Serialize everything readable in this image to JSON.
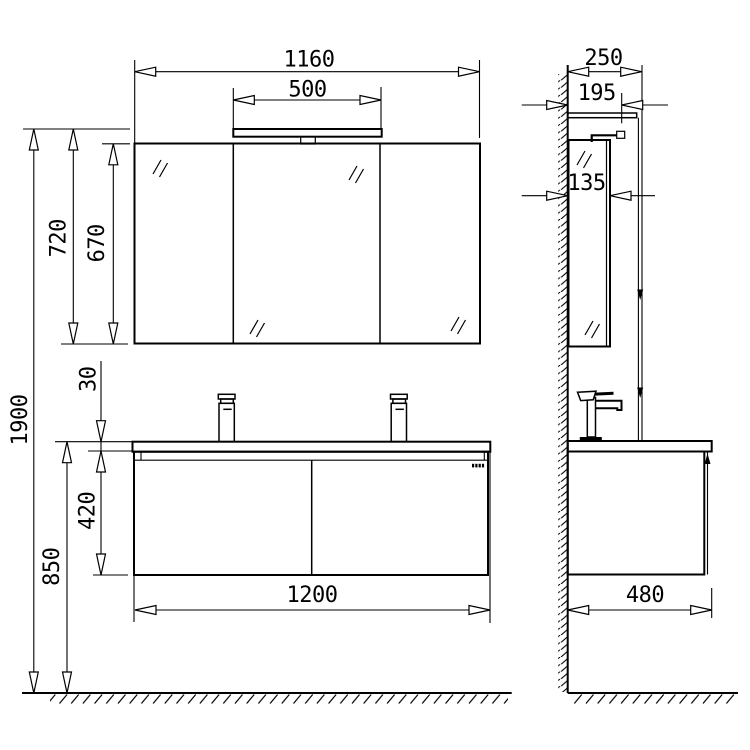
{
  "dimensions": {
    "front": {
      "total_height_mm": "1900",
      "mirror_cabinet_height_mm": "720",
      "mirror_door_height_mm": "670",
      "mirror_cabinet_width_mm": "1160",
      "light_width_mm": "500",
      "countertop_thickness_mm": "30",
      "vanity_cabinet_height_mm": "420",
      "floor_to_countertop_mm": "850",
      "vanity_width_mm": "1200"
    },
    "side": {
      "total_depth_mm": "250",
      "top_panel_depth_mm": "195",
      "mirror_cabinet_depth_mm": "135",
      "vanity_depth_mm": "480"
    }
  },
  "colors": {
    "line": "#000000",
    "background": "#ffffff"
  }
}
